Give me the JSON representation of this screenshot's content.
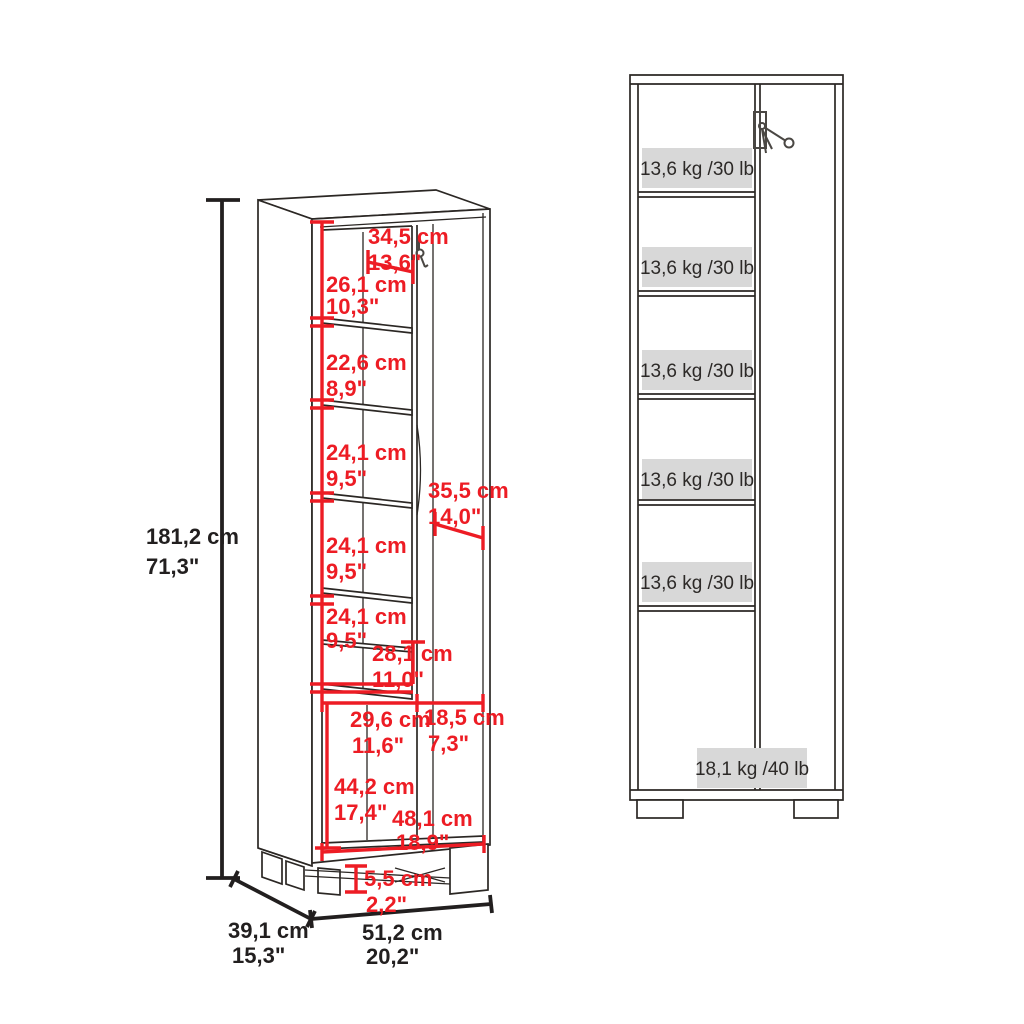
{
  "title": "cabinet dimension diagram",
  "colors": {
    "dimension_red": "#ed1c24",
    "dimension_black": "#221f1f",
    "drawing_line": "#2b2724",
    "capacity_box_gray": "#d8d8d8",
    "background": "#ffffff"
  },
  "left_view": {
    "description": "3D open view of storage cabinet with dimension callouts",
    "dimensions": {
      "overall_height": {
        "cm": "181,2 cm",
        "in": "71,3\""
      },
      "top_opening_width": {
        "cm": "34,5 cm",
        "in": "13,6\""
      },
      "compartment_1_height": {
        "cm": "26,1 cm",
        "in": "10,3\""
      },
      "compartment_2_height": {
        "cm": "22,6 cm",
        "in": "8,9\""
      },
      "compartment_3_height": {
        "cm": "24,1 cm",
        "in": "9,5\""
      },
      "compartment_4_height": {
        "cm": "24,1 cm",
        "in": "9,5\""
      },
      "compartment_5_height": {
        "cm": "24,1 cm",
        "in": "9,5\""
      },
      "compartment_6_height": {
        "cm": "28,1 cm",
        "in": "11,0\""
      },
      "door_width": {
        "cm": "35,5 cm",
        "in": "14,0\""
      },
      "bottom_left_opening_width": {
        "cm": "29,6 cm",
        "in": "11,6\""
      },
      "bottom_right_opening_width": {
        "cm": "18,5 cm",
        "in": "7,3\""
      },
      "bottom_opening_height": {
        "cm": "44,2 cm",
        "in": "17,4\""
      },
      "bottom_inner_width": {
        "cm": "48,1 cm",
        "in": "18,9\""
      },
      "foot_height": {
        "cm": "5,5 cm",
        "in": "2,2\""
      },
      "depth": {
        "cm": "39,1 cm",
        "in": "15,3\""
      },
      "overall_width": {
        "cm": "51,2 cm",
        "in": "20,2\""
      }
    }
  },
  "right_view": {
    "description": "front view of cabinet with shelf load capacities",
    "shelf_capacities": [
      "13,6 kg /30 lb",
      "13,6 kg /30 lb",
      "13,6 kg /30 lb",
      "13,6 kg /30 lb",
      "13,6 kg /30 lb"
    ],
    "base_capacity": "18,1 kg /40 lb"
  }
}
